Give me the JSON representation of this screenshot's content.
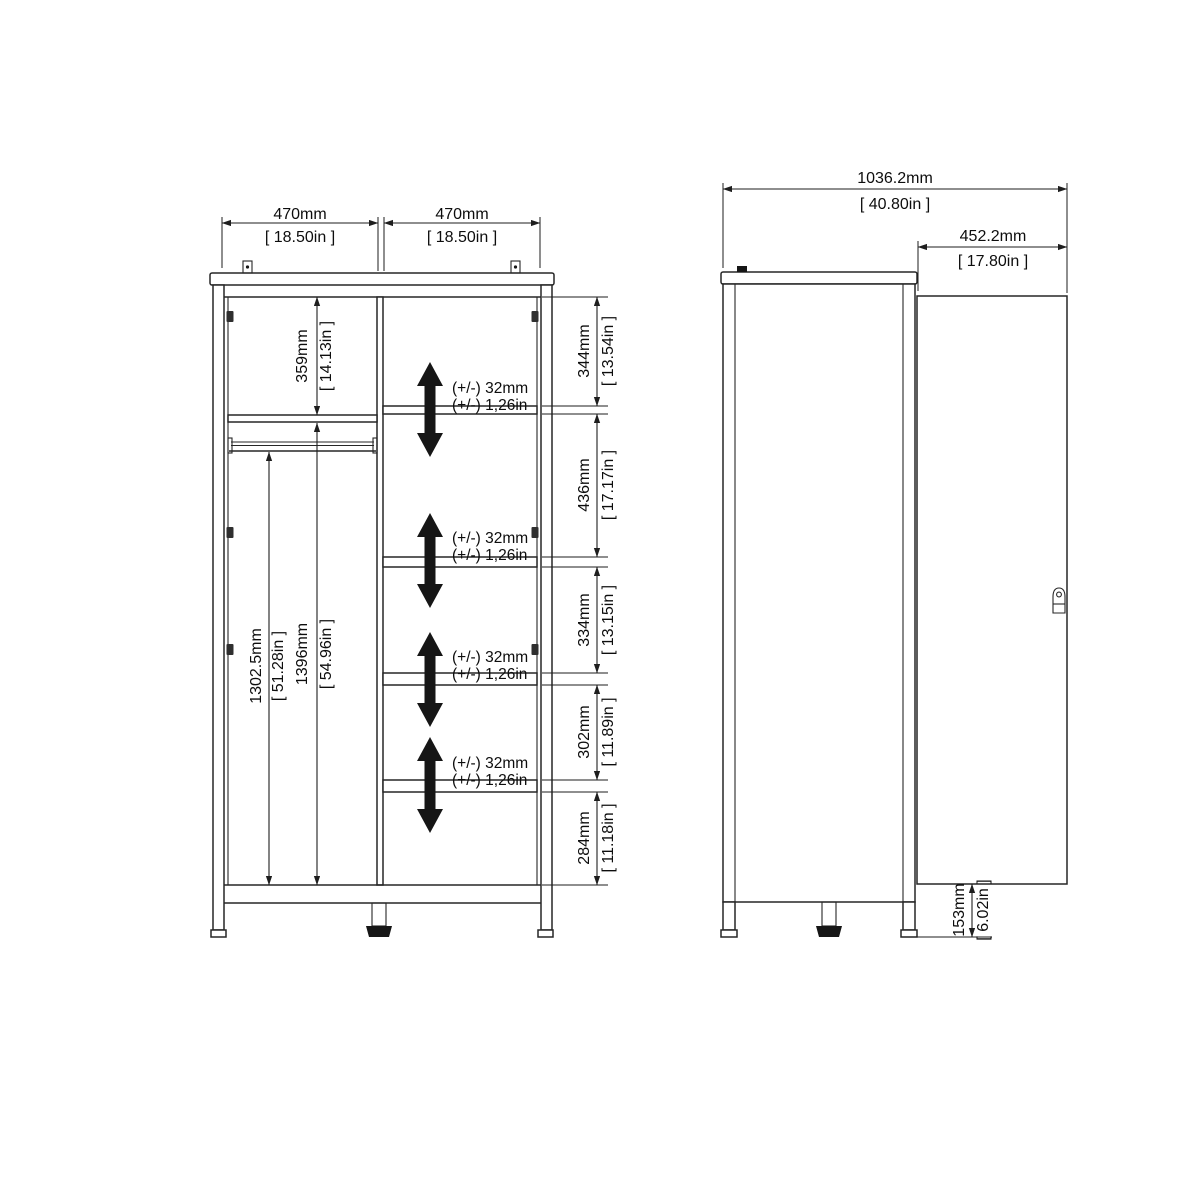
{
  "drawing": {
    "front_view": {
      "door_left_width_mm": "470mm",
      "door_left_width_in": "[ 18.50in ]",
      "door_right_width_mm": "470mm",
      "door_right_width_in": "[ 18.50in ]",
      "top_section_mm": "359mm",
      "top_section_in": "[ 14.13in ]",
      "hanging_space_mm": "1302.5mm",
      "hanging_space_in": "[ 51.28in ]",
      "interior_height_mm": "1396mm",
      "interior_height_in": "[ 54.96in ]",
      "shelf_adjust_mm": "(+/-) 32mm",
      "shelf_adjust_in": "(+/-) 1,26in",
      "sections": [
        {
          "mm": "344mm",
          "in": "[ 13.54in ]"
        },
        {
          "mm": "436mm",
          "in": "[ 17.17in ]"
        },
        {
          "mm": "334mm",
          "in": "[ 13.15in ]"
        },
        {
          "mm": "302mm",
          "in": "[ 11.89in ]"
        },
        {
          "mm": "284mm",
          "in": "[ 11.18in ]"
        }
      ]
    },
    "side_view": {
      "total_depth_mm": "1036.2mm",
      "total_depth_in": "[ 40.80in ]",
      "door_width_mm": "452.2mm",
      "door_width_in": "[ 17.80in ]",
      "plinth_height_mm": "153mm",
      "plinth_height_in": "[ 6.02in ]"
    }
  },
  "colors": {
    "line": "#262626",
    "background": "#ffffff",
    "arrow_fill": "#0c0c0c"
  }
}
